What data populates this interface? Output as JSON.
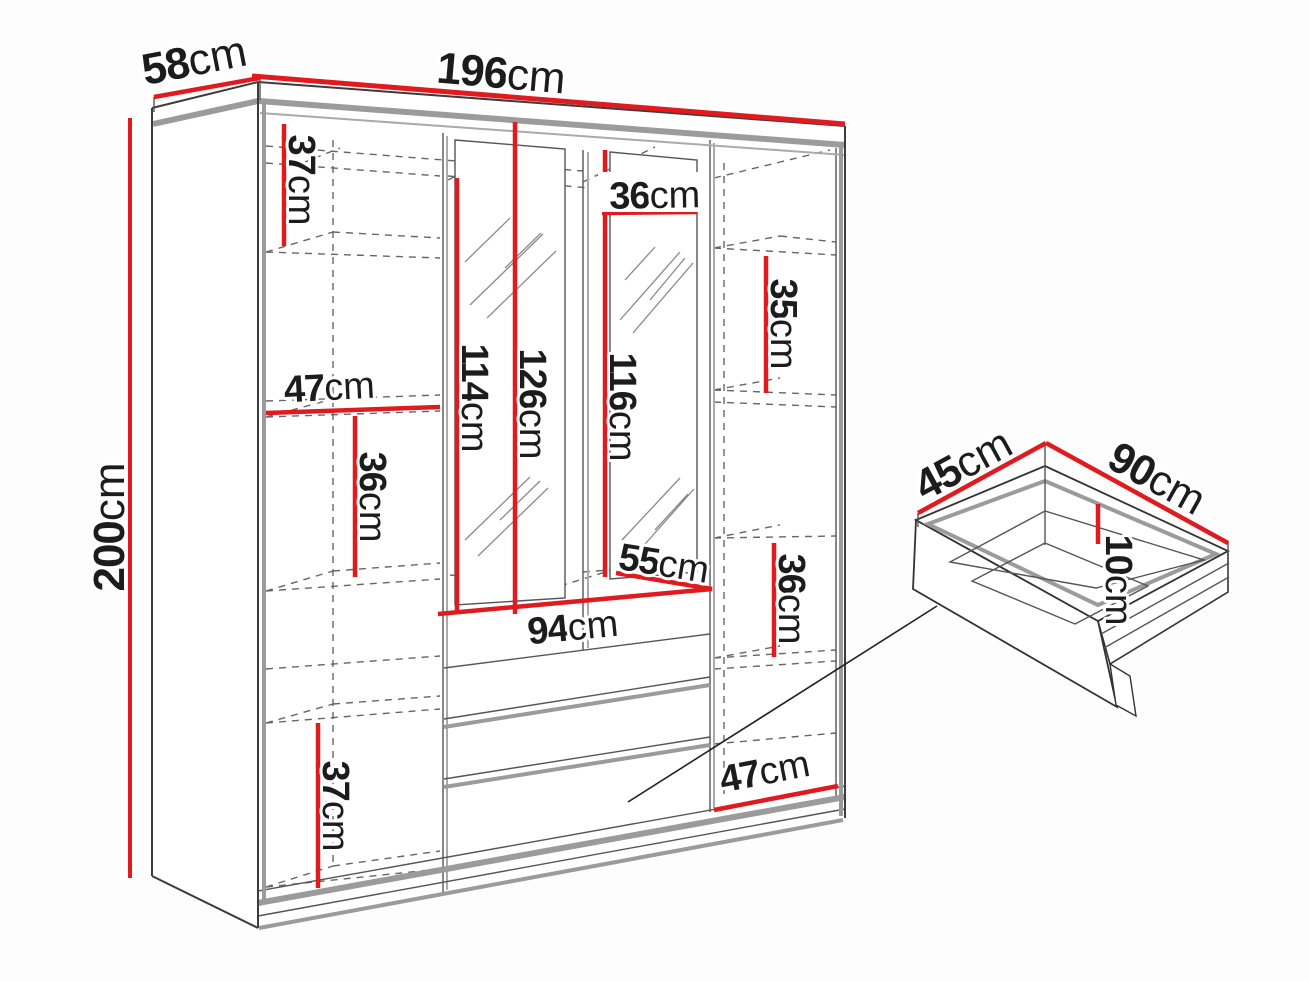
{
  "diagram": {
    "type": "furniture-dimension-diagram",
    "subject": "wardrobe with mirror doors and drawer detail",
    "unit": "cm"
  },
  "colors": {
    "dimension_line": "#e01b20",
    "outline": "#3c3c3c",
    "panel_edge": "#9b9b9b",
    "hidden_edge": "#666666",
    "background": "#ffffff"
  },
  "wardrobe": {
    "overall_dimensions": {
      "width": {
        "num": "196",
        "unit": "cm"
      },
      "depth": {
        "num": "58",
        "unit": "cm"
      },
      "height": {
        "num": "200",
        "unit": "cm"
      }
    },
    "interior_dimensions": {
      "left_top_section_height": {
        "num": "37",
        "unit": "cm"
      },
      "left_column_width": {
        "num": "47",
        "unit": "cm"
      },
      "left_middle_section_height": {
        "num": "36",
        "unit": "cm"
      },
      "left_bottom_section_height": {
        "num": "37",
        "unit": "cm"
      },
      "mirror_door_a_height": {
        "num": "114",
        "unit": "cm"
      },
      "mirror_door_b_height": {
        "num": "126",
        "unit": "cm"
      },
      "mirror_door_c_height": {
        "num": "116",
        "unit": "cm"
      },
      "mirror_top_width": {
        "num": "36",
        "unit": "cm"
      },
      "shelf_diagonal_depth": {
        "num": "55",
        "unit": "cm"
      },
      "drawer_section_width": {
        "num": "94",
        "unit": "cm"
      },
      "right_top_section_height": {
        "num": "35",
        "unit": "cm"
      },
      "right_middle_section_height": {
        "num": "36",
        "unit": "cm"
      },
      "right_column_width": {
        "num": "47",
        "unit": "cm"
      }
    }
  },
  "drawer_detail": {
    "depth": {
      "num": "45",
      "unit": "cm"
    },
    "width": {
      "num": "90",
      "unit": "cm"
    },
    "height": {
      "num": "10",
      "unit": "cm"
    }
  }
}
